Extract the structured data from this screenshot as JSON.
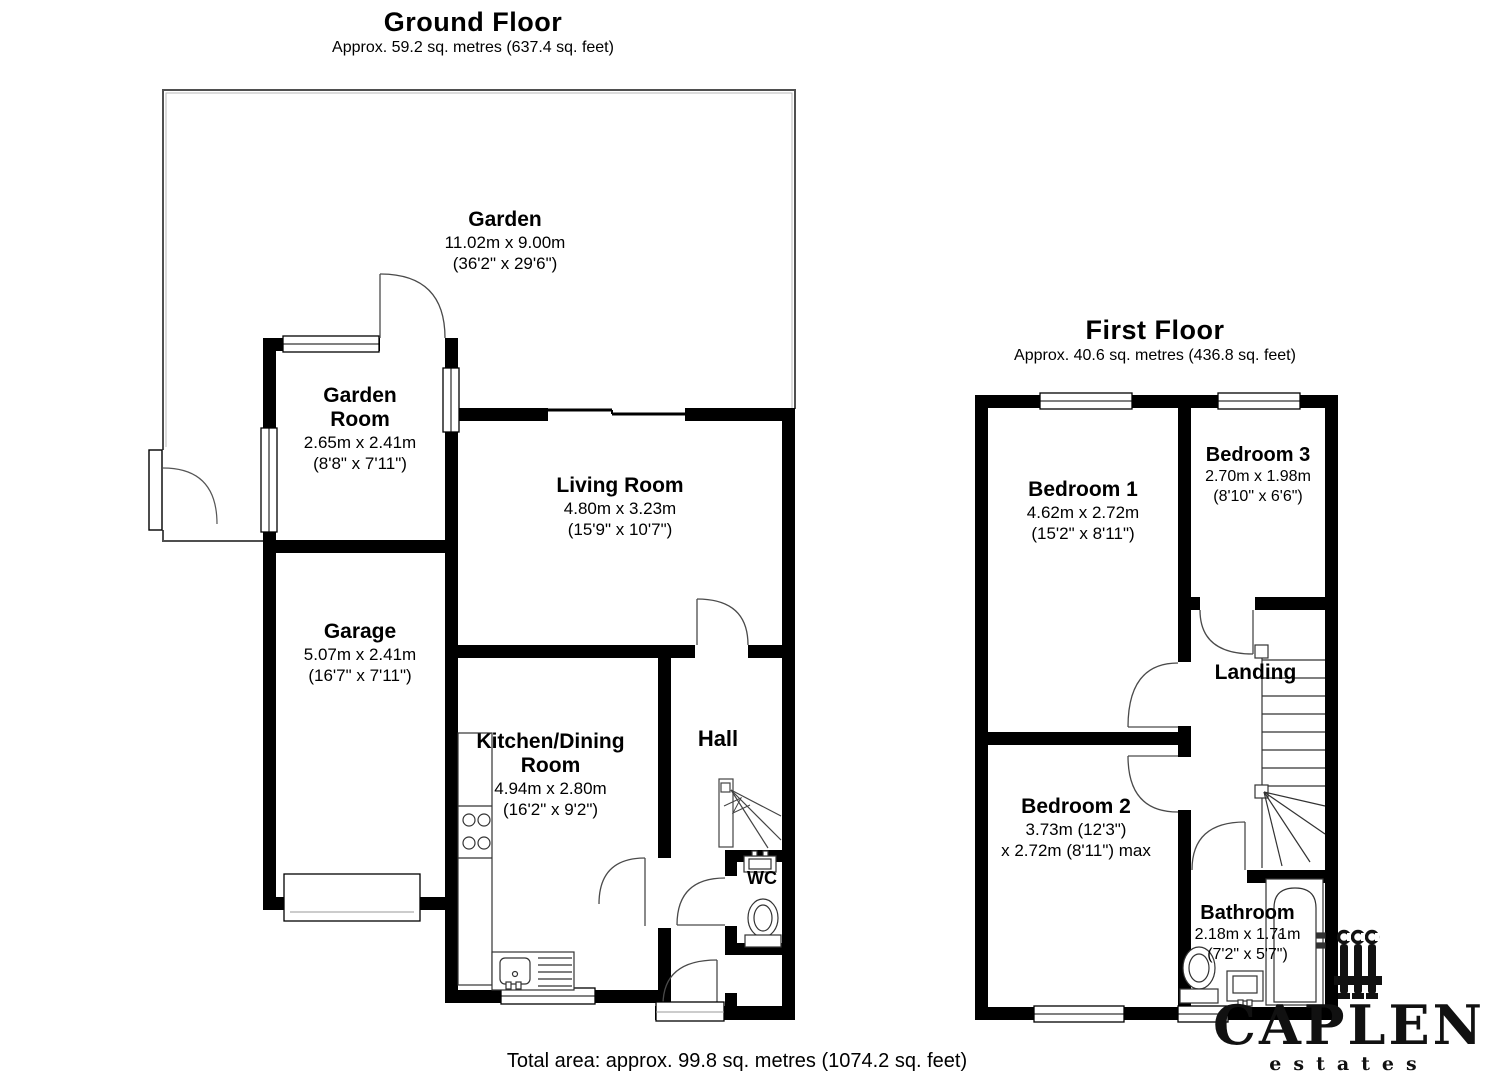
{
  "ground_floor": {
    "title": "Ground Floor",
    "subtitle": "Approx. 59.2 sq. metres (637.4 sq. feet)",
    "rooms": {
      "garden": {
        "name": "Garden",
        "dims1": "11.02m x 9.00m",
        "dims2": "(36'2\" x 29'6\")"
      },
      "garden_room": {
        "name": "Garden Room",
        "dims1": "2.65m x 2.41m",
        "dims2": "(8'8\" x 7'11\")"
      },
      "living_room": {
        "name": "Living Room",
        "dims1": "4.80m x 3.23m",
        "dims2": "(15'9\" x 10'7\")"
      },
      "garage": {
        "name": "Garage",
        "dims1": "5.07m x 2.41m",
        "dims2": "(16'7\" x 7'11\")"
      },
      "kitchen": {
        "name": "Kitchen/Dining Room",
        "dims1": "4.94m x 2.80m",
        "dims2": "(16'2\" x 9'2\")"
      },
      "hall": {
        "name": "Hall"
      },
      "wc": {
        "name": "WC"
      }
    }
  },
  "first_floor": {
    "title": "First Floor",
    "subtitle": "Approx. 40.6 sq. metres (436.8 sq. feet)",
    "rooms": {
      "bedroom1": {
        "name": "Bedroom 1",
        "dims1": "4.62m x 2.72m",
        "dims2": "(15'2\" x 8'11\")"
      },
      "bedroom2": {
        "name": "Bedroom 2",
        "dims1": "3.73m (12'3\")",
        "dims2": "x 2.72m (8'11\") max"
      },
      "bedroom3": {
        "name": "Bedroom 3",
        "dims1": "2.70m x 1.98m",
        "dims2": "(8'10\" x 6'6\")"
      },
      "landing": {
        "name": "Landing"
      },
      "bathroom": {
        "name": "Bathroom",
        "dims1": "2.18m x 1.71m",
        "dims2": "(7'2\" x 5'7\")"
      }
    }
  },
  "footer": {
    "total_area": "Total area: approx. 99.8 sq. metres (1074.2 sq. feet)"
  },
  "logo": {
    "name": "CAPLEN",
    "tagline": "estates"
  },
  "colors": {
    "wall": "#000000",
    "line": "#444444",
    "boundary": "#4f4f4f",
    "background": "#ffffff"
  }
}
